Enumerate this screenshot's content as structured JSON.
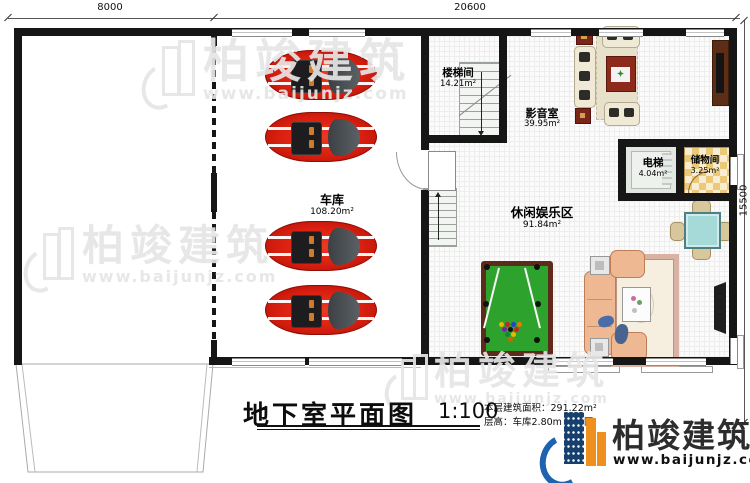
{
  "plan": {
    "dimensions": {
      "top_left": "8000",
      "top_right": "20600",
      "right": "15500"
    },
    "rooms": [
      {
        "name": "车库",
        "area": "108.20m²"
      },
      {
        "name": "楼梯间",
        "area": "14.21m²"
      },
      {
        "name": "影音室",
        "area": "39.95m²"
      },
      {
        "name": "电梯",
        "area": "4.04m²"
      },
      {
        "name": "储物间",
        "area": "3.25m²"
      },
      {
        "name": "休闲娱乐区",
        "area": "91.84m²"
      }
    ],
    "icons": [
      "car-icon",
      "pool-table-icon",
      "sofa-set-icon",
      "stairs-icon",
      "door-swing-icon",
      "tv-icon",
      "tea-table-icon",
      "rug-icon"
    ]
  },
  "title_block": {
    "title": "地下室平面图",
    "scale": "1:100",
    "area_note": "本层建筑面积：291.22m²",
    "height_note": "层高：车库2.80m 娱乐区"
  },
  "branding": {
    "name": "柏竣建筑",
    "website": "www.baijunjz.com"
  },
  "watermark": {
    "name": "柏竣建筑",
    "website": "www.baijunjz.com"
  },
  "colors": {
    "wall": "#161616",
    "car_red": "#d81e0f",
    "pool_green": "#2da32d",
    "pool_frame": "#5e2b1b",
    "checker_tan": "#eac979",
    "sofa_salmon": "#eeb893",
    "media_cream": "#efe9d6",
    "side_table_red": "#7c241a",
    "tea_table_teal": "#a6dad8",
    "logo_blue": "#1e63b0",
    "logo_navy": "#17406e",
    "logo_orange": "#ef8f1d"
  }
}
